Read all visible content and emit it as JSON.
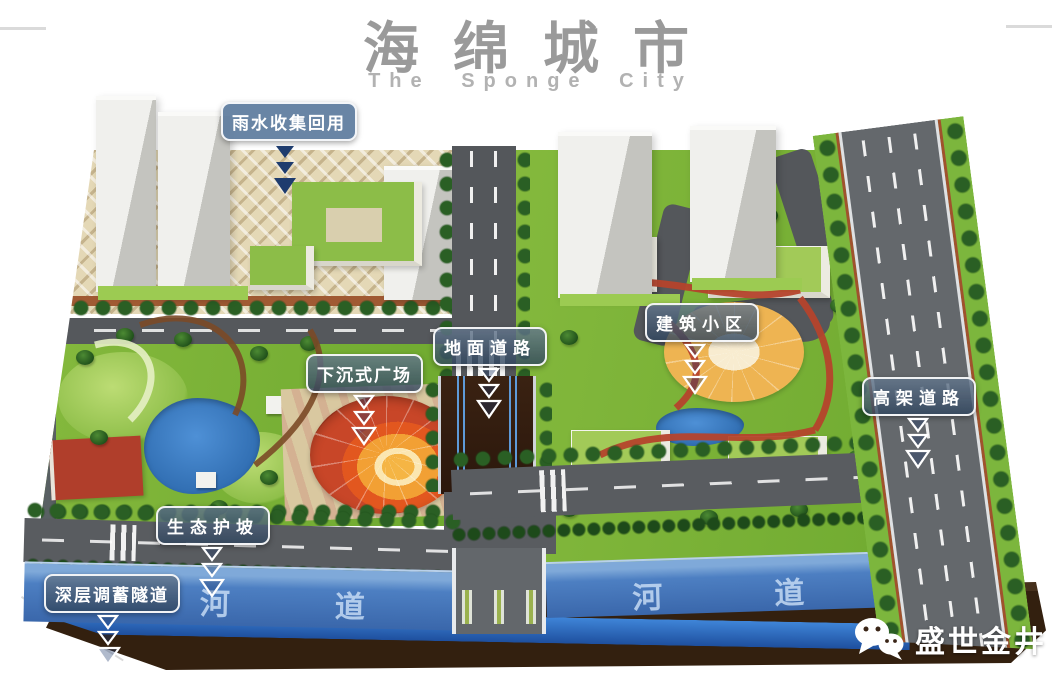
{
  "header": {
    "title": "海绵城市",
    "subtitle": "The Sponge City"
  },
  "callouts": [
    {
      "id": "rainwater-reuse",
      "label": "雨水收集回用",
      "arrow_style": "solid-navy"
    },
    {
      "id": "sunken-plaza",
      "label": "下沉式广场",
      "arrow_style": "outline-white"
    },
    {
      "id": "ground-road",
      "label": "地面道路",
      "arrow_style": "outline-white"
    },
    {
      "id": "building-community",
      "label": "建筑小区",
      "arrow_style": "outline-white"
    },
    {
      "id": "elevated-road",
      "label": "高架道路",
      "arrow_style": "outline-white"
    },
    {
      "id": "eco-slope",
      "label": "生态护坡",
      "arrow_style": "outline-white"
    },
    {
      "id": "deep-storage-tunnel",
      "label": "深层调蓄隧道",
      "arrow_style": "outline-white"
    }
  ],
  "scene": {
    "rivers": [
      {
        "label": "河道"
      },
      {
        "label": "河道"
      }
    ],
    "watermark": {
      "icon": "wechat-icon",
      "label": "盛世金井"
    }
  },
  "palette": {
    "title_gray": "#9a9a9a",
    "label_bg": "#374f6b",
    "label_border": "#ffffff",
    "grass_green": "#7fb73c",
    "river_blue": "#4d7fc2",
    "tunnel_blue": "#2e6cc0",
    "soil_brown": "#33200f",
    "plaza_red": "#c84628",
    "plaza_orange": "#eda43e",
    "road_gray": "#595c60",
    "paving_tan": "#e4d8b6"
  }
}
